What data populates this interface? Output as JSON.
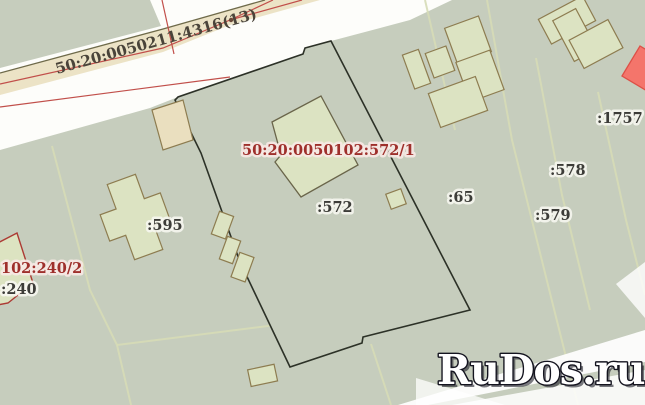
{
  "map": {
    "parcel_labels": {
      "road": "50:20:0050211:4316(13)",
      "selected_full": "50:20:0050102:572/1",
      "selected_short": ":572",
      "p595": ":595",
      "p65": ":65",
      "p578": ":578",
      "p579": ":579",
      "p1757": ":1757",
      "p240_full": "102:240/2",
      "p240_short": ":240"
    },
    "watermark": "RuDos.ru",
    "colors": {
      "background_green": "#c6cdbd",
      "building_fill": "#dce3c2",
      "building_outline": "#8d7c50",
      "road_fill": "#ece3c6",
      "selected_boundary": "#2c3127",
      "red_boundary_line": "#c14f4a",
      "red_label": "#9e2f2b",
      "gray_label": "#3c3c38",
      "highlighted_parcel_fill": "#f4756b",
      "watermark_text": "#ffffff"
    }
  }
}
